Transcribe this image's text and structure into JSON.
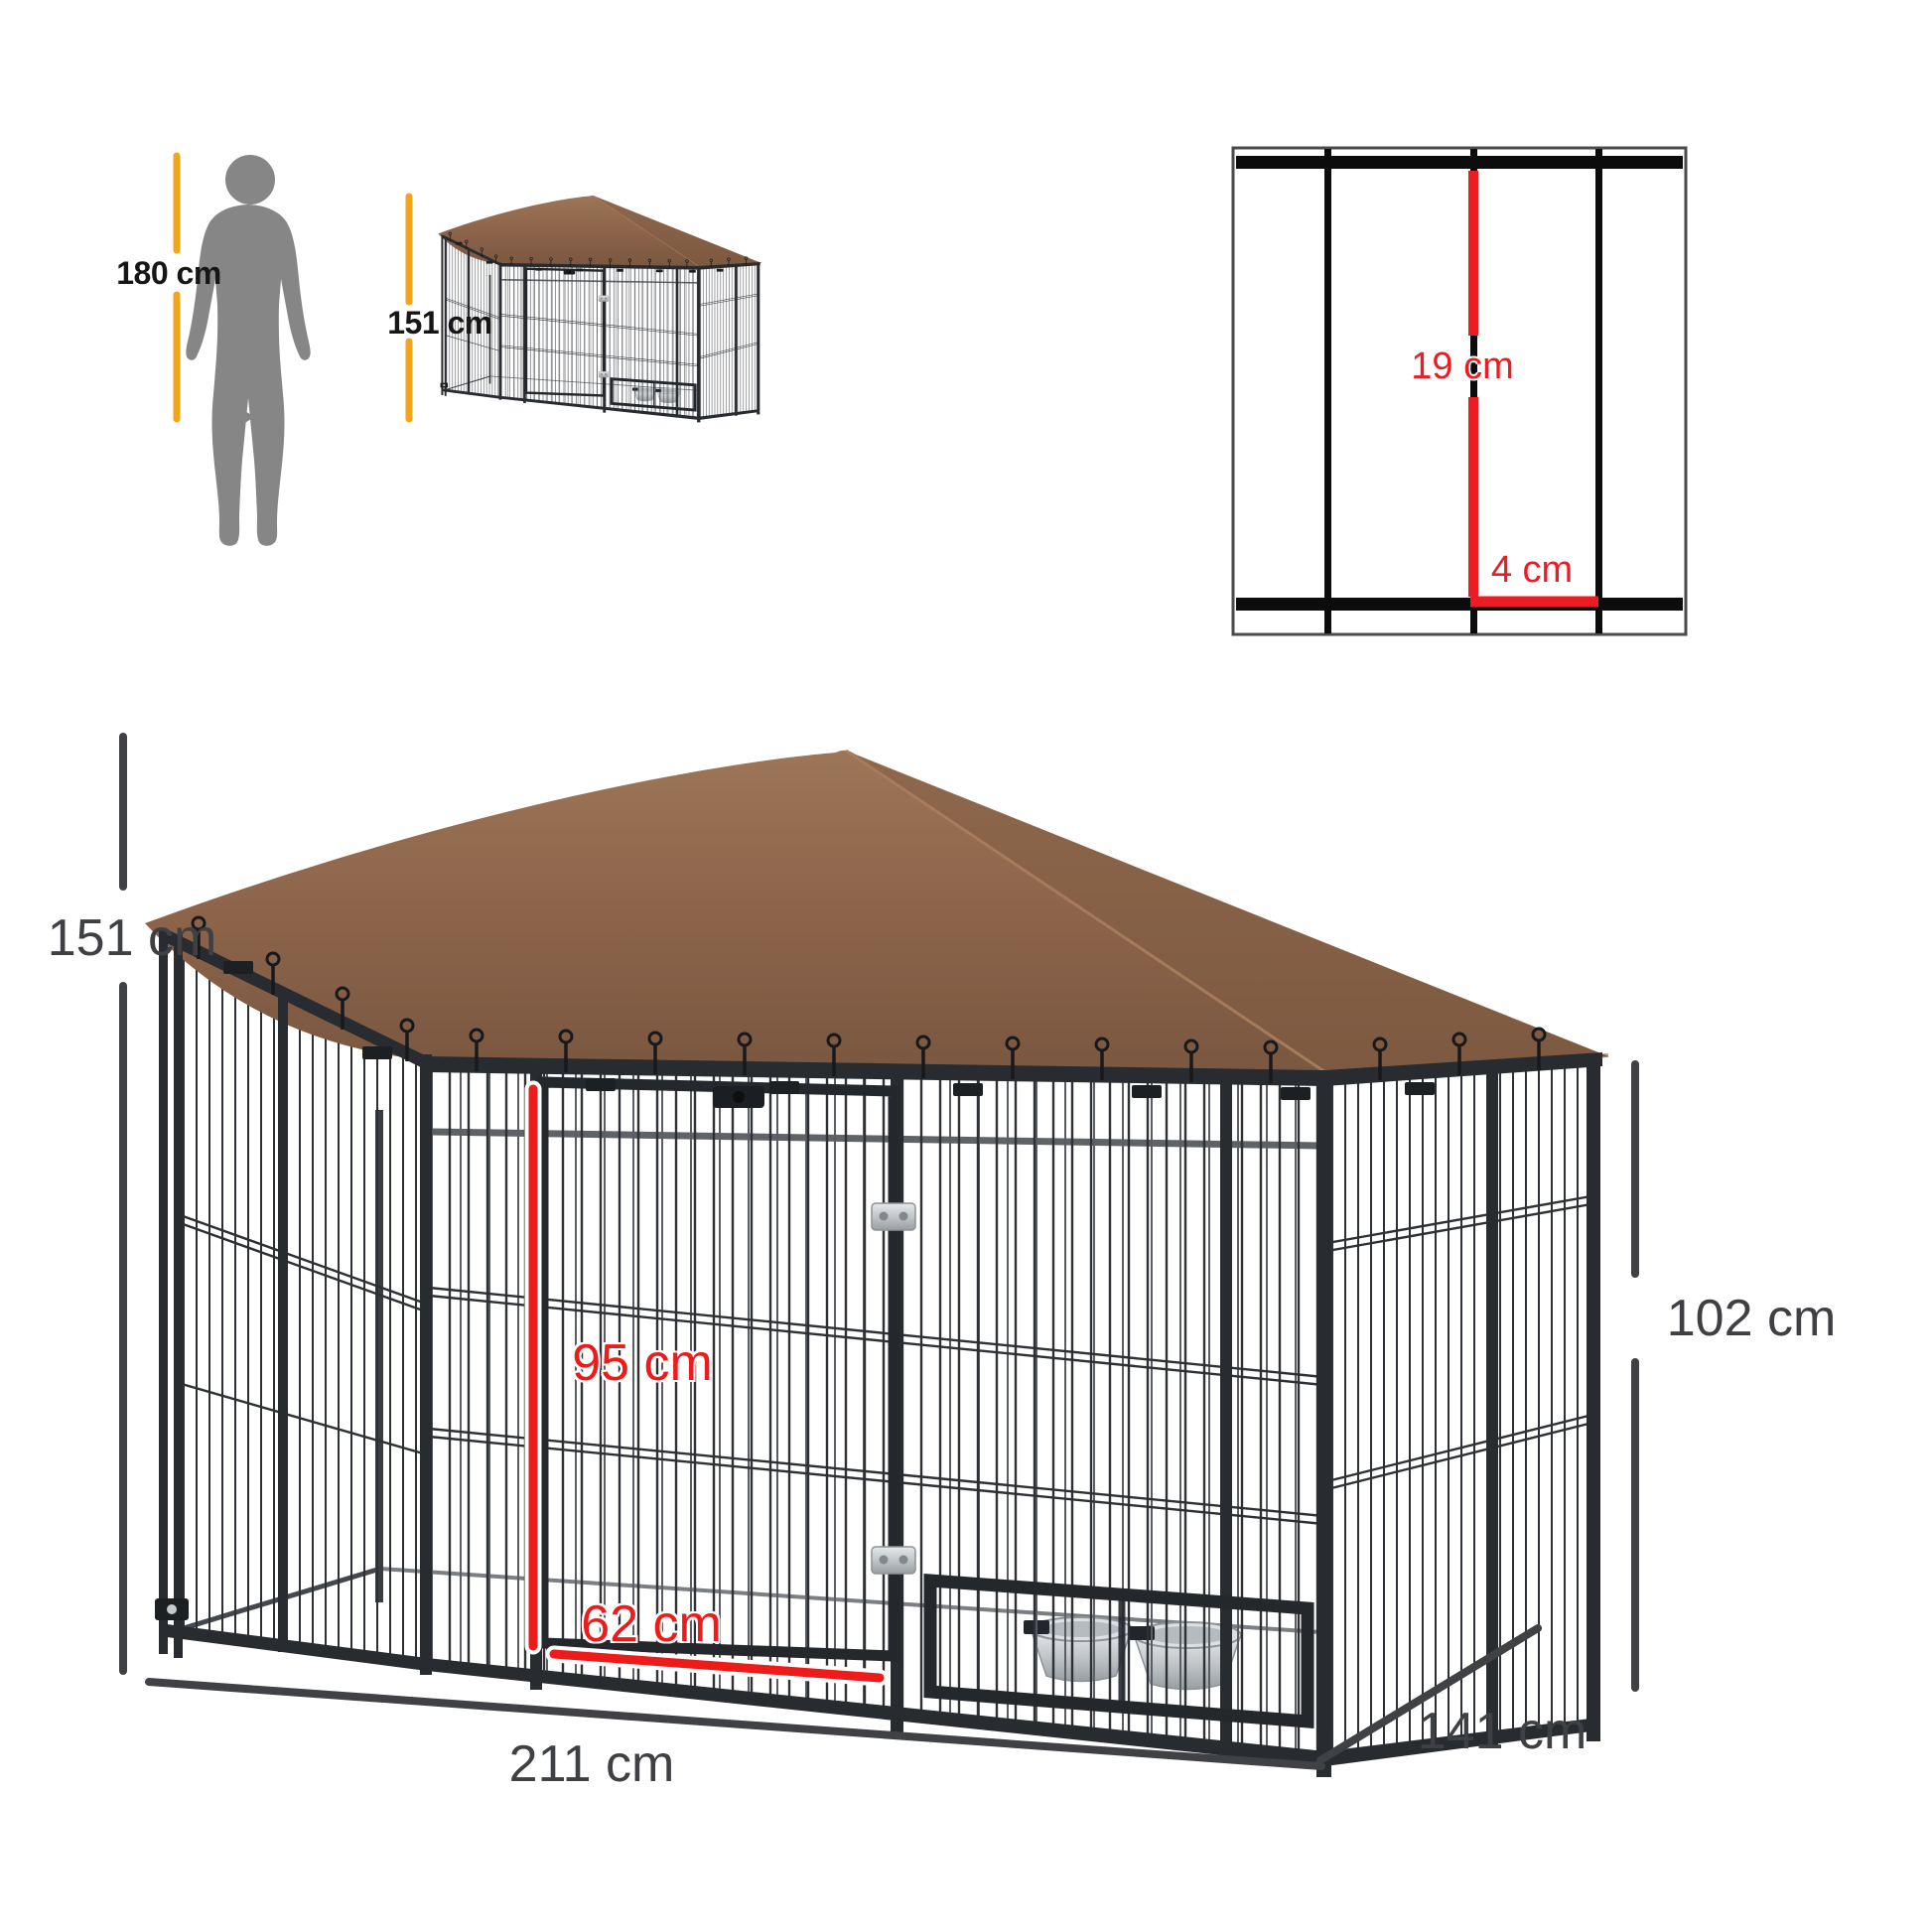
{
  "scale_reference": {
    "human_height_label": "180 cm",
    "kennel_height_label": "151 cm"
  },
  "wire_spacing_detail": {
    "vertical_gap_label": "19 cm",
    "horizontal_gap_label": "4 cm"
  },
  "dimensions": {
    "overall_height_label": "151 cm",
    "side_wall_height_label": "102 cm",
    "door_height_label": "95 cm",
    "door_width_label": "62 cm",
    "overall_width_label": "211 cm",
    "overall_depth_label": "141 cm"
  },
  "colors": {
    "accent_orange": "#F2A41B",
    "accent_red": "#ED1C24",
    "dimension_gray": "#3F4145",
    "roof_brown": "#8A6349",
    "frame_black": "#282B30",
    "silhouette_gray": "#868686",
    "steel_silver": "#C7CACD"
  }
}
